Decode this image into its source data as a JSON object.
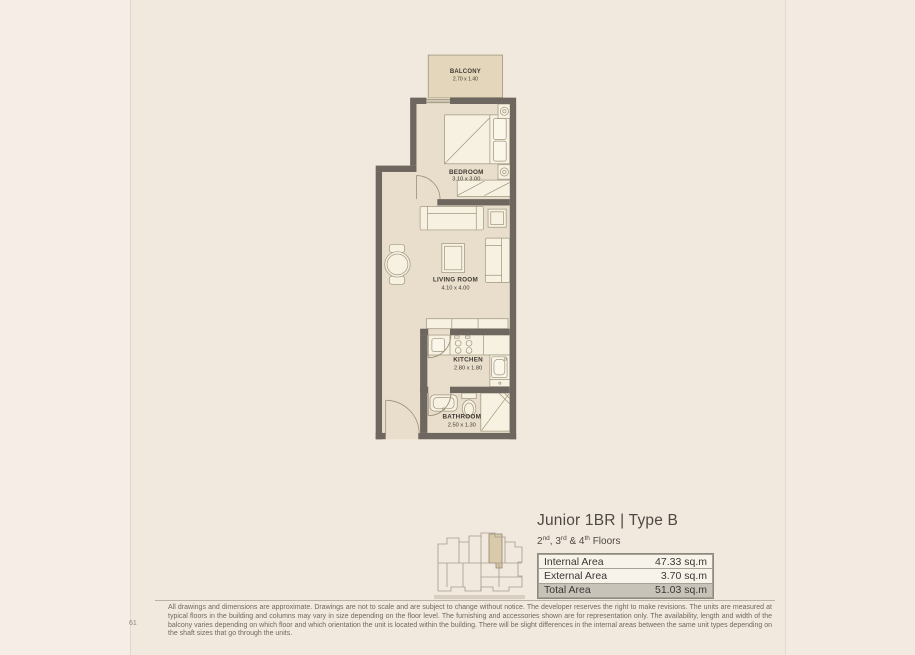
{
  "colors": {
    "page_background": "#f1e9dd",
    "wall": "#6e675f",
    "room_fill": "#e9decb",
    "balcony_fill": "#e3d6ba",
    "furniture_fill": "#f7f1e2",
    "table_highlight_row": "#c8c3b9",
    "keyplan_unit_highlight": "#d9caa9",
    "text_dark": "#3f3a32"
  },
  "floor_plan": {
    "rooms": [
      {
        "name": "BALCONY",
        "dims": "2.70 x 1.40"
      },
      {
        "name": "BEDROOM",
        "dims": "3.10 x 3.00"
      },
      {
        "name": "LIVING ROOM",
        "dims": "4.10 x 4.00"
      },
      {
        "name": "KITCHEN",
        "dims": "2.80 x 1.80"
      },
      {
        "name": "BATHROOM",
        "dims": "2.50 x 1.30"
      }
    ]
  },
  "unit_info": {
    "title": "Junior 1BR | Type B",
    "floors": {
      "n1": "2",
      "o1": "nd",
      "n2": ", 3",
      "o2": "rd",
      "n3": " & 4",
      "o3": "th",
      "rest": " Floors"
    },
    "area_table": {
      "rows": [
        {
          "label": "Internal Area",
          "value": "47.33 sq.m"
        },
        {
          "label": "External Area",
          "value": "3.70 sq.m"
        },
        {
          "label": "Total Area",
          "value": "51.03 sq.m"
        }
      ]
    }
  },
  "footer": {
    "page_number": "61",
    "disclaimer": "All drawings and dimensions are approximate. Drawings are not to scale and are subject to change without notice. The developer reserves the right to make revisions. The units are measured at typical floors in the building and columns may vary in size depending on the floor level. The furnishing and accessories shown are for representation only. The availability, length and width of the balcony varies depending on which floor and which orientation the unit is located within the building. There will be slight differences in the internal areas between the same unit types depending on the shaft sizes that go through the units."
  }
}
